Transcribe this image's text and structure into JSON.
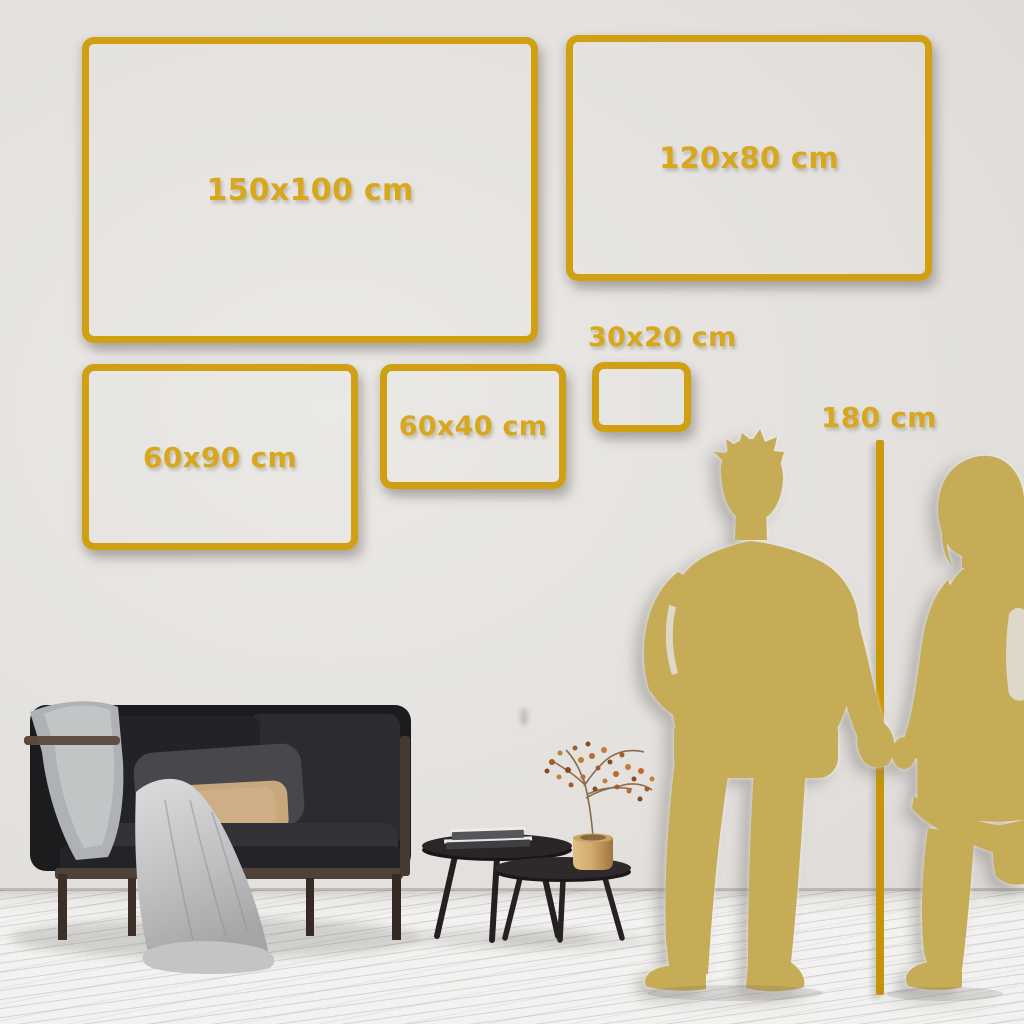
{
  "scene": {
    "title": "wall-art-size-comparison-guide",
    "colors": {
      "accent_gold": "#CFA014",
      "label_gold": "#D7A71D",
      "ruler_gold": "#C89808",
      "silhouette_gold": "#C6AC57",
      "wall": "#E2DFDC",
      "floor": "#F3F2F0",
      "sofa": "#1E1E21",
      "pillow_tan": "#C8A77C",
      "blanket_gray": "#C6C8CA",
      "vase_brass": "#C89B5C"
    }
  },
  "frames": [
    {
      "id": "150x100",
      "label": "150x100 cm"
    },
    {
      "id": "120x80",
      "label": "120x80 cm"
    },
    {
      "id": "60x90",
      "label": "60x90 cm"
    },
    {
      "id": "60x40",
      "label": "60x40 cm"
    },
    {
      "id": "30x20",
      "label": "30x20 cm"
    }
  ],
  "height_reference": {
    "label": "180 cm"
  }
}
